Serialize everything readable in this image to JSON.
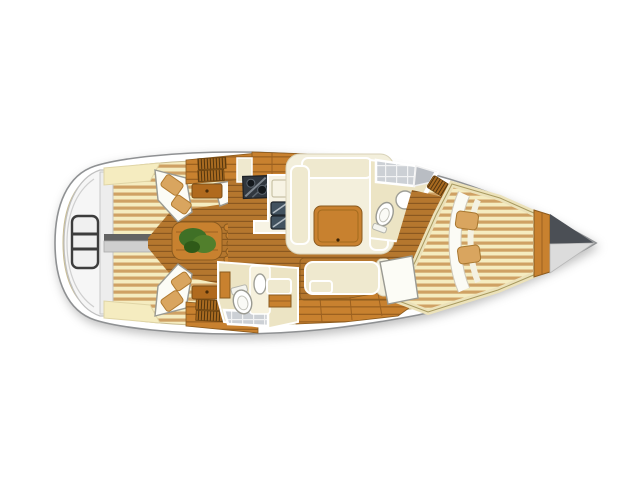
{
  "palette": {
    "hull_outline": "#8f9193",
    "deck_cream": "#f5ecc0",
    "deck_tan": "#cfa164",
    "teak_base": "#b5772e",
    "teak_line": "#8a5820",
    "wood_base": "#c8812f",
    "wood_dark": "#9c6120",
    "cushion": "#efe9cf",
    "stove": "#31373e",
    "sink_steel": "#42525f",
    "tile": "#ccd0d5",
    "plant_green": "#3f7026",
    "pillow_tan": "#d9a55f",
    "anchor_dark": "#4b4f55",
    "anchor_light": "#dcdcdc",
    "transom_gray": "#ededed",
    "walkway_dark": "#636363",
    "walkway_light": "#cfcfcf"
  },
  "areas": {
    "plan": "sailing yacht interior layout, top view, bow pointing right",
    "hull": "hull and deck",
    "swim_platform": "transom swim platform with boarding ladder",
    "cockpit": "cockpit with teak sole, table and wheel steps",
    "aft_cabin_port": "aft cabin berth (top)",
    "aft_cabin_starboard": "aft cabin berth (bottom)",
    "galley": "galley with stove and double sink",
    "saloon": "saloon with U-settee and table",
    "aft_head": "aft head with toilet, basin and shower",
    "forward_head": "forward head with shower, basin and toilet",
    "forward_cabin": "forward V-berth cabin",
    "bow_locker": "bow anchor locker"
  }
}
